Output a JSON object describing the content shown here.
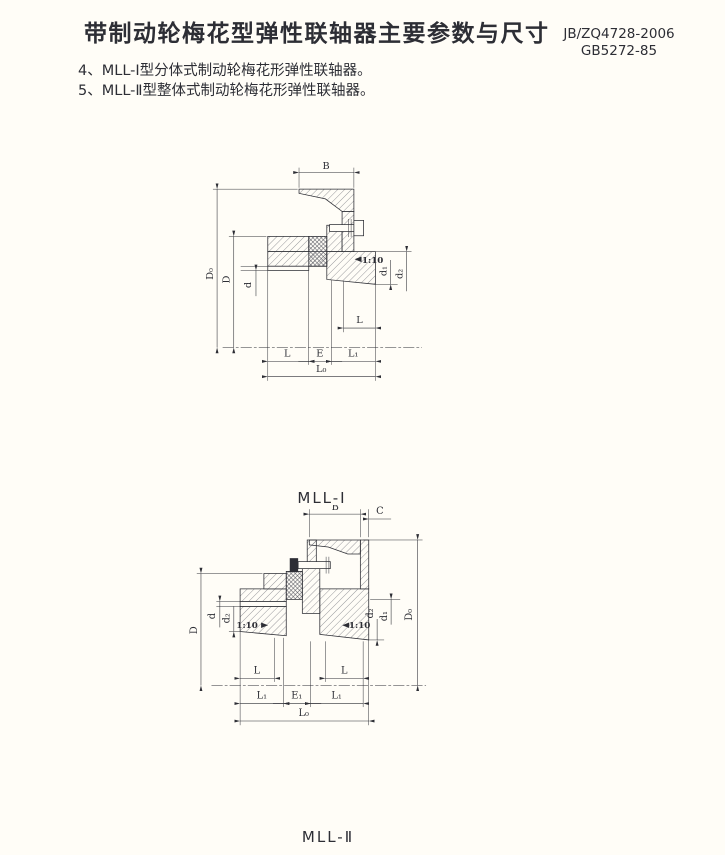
{
  "header": {
    "title": "带制动轮梅花型弹性联轴器主要参数与尺寸",
    "standard_1": "JB/ZQ4728-2006",
    "standard_2": "GB5272-85"
  },
  "notes": {
    "item4": "4、MLL-Ⅰ型分体式制动轮梅花形弹性联轴器。",
    "item5": "5、MLL-Ⅱ型整体式制动轮梅花形弹性联轴器。"
  },
  "figure_mll1": {
    "caption": "MLL-Ⅰ",
    "dims": {
      "B": "B",
      "D0": "D₀",
      "D": "D",
      "d": "d",
      "taper": "1:10",
      "d1": "d₁",
      "d2": "d₂",
      "L_hub_right": "L",
      "L_left": "L",
      "E": "E",
      "L1": "L₁",
      "L0": "L₀"
    }
  },
  "figure_mll2": {
    "caption": "MLL-Ⅱ",
    "dims": {
      "B": "B",
      "C": "C",
      "D": "D",
      "d": "d",
      "d2_left": "d₂",
      "taper_left": "1:10",
      "taper_right": "1:10",
      "d2_right": "d₂",
      "d1": "d₁",
      "D0": "D₀",
      "L_left": "L",
      "L_right": "L",
      "L1_left": "L₁",
      "E1": "E₁",
      "L1_right": "L₁",
      "L0": "L₀"
    }
  },
  "colors": {
    "paper": "#fffdf7",
    "ink": "#2d2e35"
  }
}
